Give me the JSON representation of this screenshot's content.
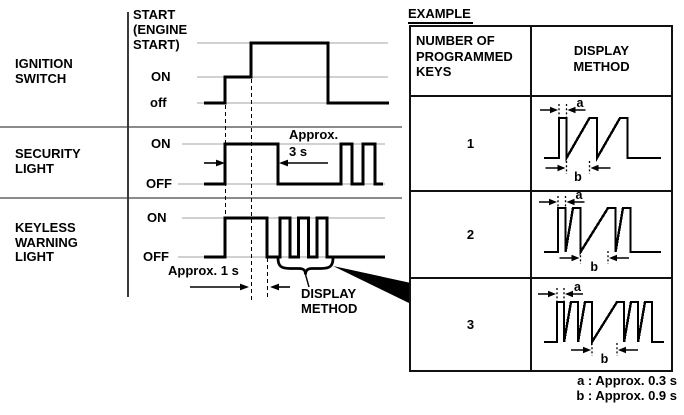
{
  "colors": {
    "ink": "#000000",
    "grid_gray": "#a3a3a3",
    "divider_gray": "#8b8b8b"
  },
  "timing_diagram": {
    "signals": [
      {
        "name": "IGNITION\nSWITCH",
        "levels": {
          "top": "START\n(ENGINE\nSTART)",
          "mid": "ON",
          "bottom": "off"
        }
      },
      {
        "name": "SECURITY\nLIGHT",
        "levels": {
          "on": "ON",
          "off": "OFF"
        },
        "annotation": "Approx.\n3 s"
      },
      {
        "name": "KEYLESS\nWARNING\nLIGHT",
        "levels": {
          "on": "ON",
          "off": "OFF"
        },
        "annotation": "Approx. 1 s"
      }
    ],
    "callout_label": "DISPLAY\nMETHOD"
  },
  "example_table": {
    "title": "EXAMPLE",
    "columns": [
      "NUMBER OF\nPROGRAMMED\nKEYS",
      "DISPLAY\nMETHOD"
    ],
    "rows": [
      {
        "keys": "1",
        "blinks_per_group": 1,
        "groups": 3
      },
      {
        "keys": "2",
        "blinks_per_group": 2,
        "groups": 2
      },
      {
        "keys": "3",
        "blinks_per_group": 3,
        "groups": 2
      }
    ],
    "measure_labels": {
      "a": "a",
      "b": "b"
    },
    "footnotes": [
      "a : Approx. 0.3 s",
      "b : Approx. 0.9 s"
    ]
  }
}
